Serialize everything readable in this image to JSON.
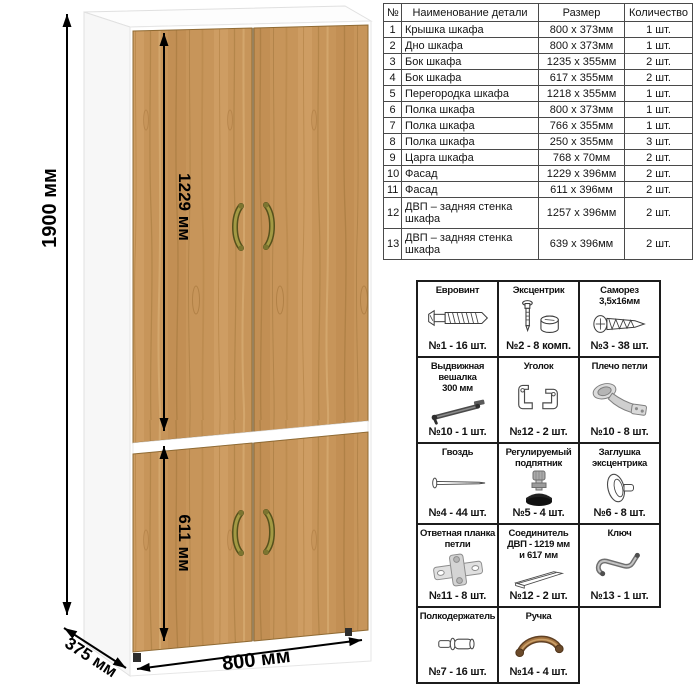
{
  "diagram": {
    "dim_height": "1900 мм",
    "dim_top_section": "1229 мм",
    "dim_bottom_section": "611 мм",
    "dim_width": "800 мм",
    "dim_depth": "375 мм",
    "wood_color": "#c7955a",
    "carcass_color": "#ffffff",
    "handle_color": "#8f8a2f"
  },
  "parts_table": {
    "headers": {
      "num": "№",
      "name": "Наименование детали",
      "size": "Размер",
      "qty": "Количество"
    },
    "rows": [
      {
        "num": "1",
        "name": "Крышка шкафа",
        "size": "800 х 373мм",
        "qty": "1 шт."
      },
      {
        "num": "2",
        "name": "Дно шкафа",
        "size": "800 х 373мм",
        "qty": "1 шт."
      },
      {
        "num": "3",
        "name": "Бок шкафа",
        "size": "1235 х 355мм",
        "qty": "2 шт."
      },
      {
        "num": "4",
        "name": "Бок шкафа",
        "size": "617 х 355мм",
        "qty": "2 шт."
      },
      {
        "num": "5",
        "name": "Перегородка шкафа",
        "size": "1218 х 355мм",
        "qty": "1 шт."
      },
      {
        "num": "6",
        "name": "Полка шкафа",
        "size": "800 х 373мм",
        "qty": "1 шт."
      },
      {
        "num": "7",
        "name": "Полка шкафа",
        "size": "766 х 355мм",
        "qty": "1 шт."
      },
      {
        "num": "8",
        "name": "Полка шкафа",
        "size": "250 х 355мм",
        "qty": "3 шт."
      },
      {
        "num": "9",
        "name": "Царга шкафа",
        "size": "768 х 70мм",
        "qty": "2 шт."
      },
      {
        "num": "10",
        "name": "Фасад",
        "size": "1229 х 396мм",
        "qty": "2 шт."
      },
      {
        "num": "11",
        "name": "Фасад",
        "size": "611 х 396мм",
        "qty": "2 шт."
      },
      {
        "num": "12",
        "name": "ДВП – задняя стенка шкафа",
        "size": "1257 х 396мм",
        "qty": "2 шт."
      },
      {
        "num": "13",
        "name": "ДВП – задняя стенка шкафа",
        "size": "639 х 396мм",
        "qty": "2 шт."
      }
    ]
  },
  "hardware": {
    "items": [
      {
        "title": "Евровинт",
        "count": "№1 - 16 шт.",
        "icon": "euro-screw-icon"
      },
      {
        "title": "Эксцентрик",
        "count": "№2 - 8 комп.",
        "icon": "cam-lock-icon"
      },
      {
        "title": "Саморез\n3,5х16мм",
        "count": "№3 - 38 шт.",
        "icon": "self-tapping-screw-icon"
      },
      {
        "title": "Выдвижная\nвешалка\n300 мм",
        "count": "№10 - 1 шт.",
        "icon": "pullout-hanger-icon"
      },
      {
        "title": "Уголок",
        "count": "№12 - 2 шт.",
        "icon": "corner-bracket-icon"
      },
      {
        "title": "Плечо петли",
        "count": "№10 - 8 шт.",
        "icon": "hinge-arm-icon"
      },
      {
        "title": "Гвоздь",
        "count": "№4 - 44 шт.",
        "icon": "nail-icon"
      },
      {
        "title": "Регулируемый\nподпятник",
        "count": "№5 - 4 шт.",
        "icon": "adjustable-foot-icon"
      },
      {
        "title": "Заглушка\nэксцентрика",
        "count": "№6 - 8 шт.",
        "icon": "cam-cover-icon"
      },
      {
        "title": "Ответная планка\nпетли",
        "count": "№11 - 8 шт.",
        "icon": "hinge-plate-icon"
      },
      {
        "title": "Соединитель\nДВП - 1219 мм\nи 617 мм",
        "count": "№12 - 2 шт.",
        "icon": "hdf-connector-icon"
      },
      {
        "title": "Ключ",
        "count": "№13 - 1 шт.",
        "icon": "hex-key-icon"
      },
      {
        "title": "Полкодержатель",
        "count": "№7 - 16 шт.",
        "icon": "shelf-pin-icon"
      },
      {
        "title": "Ручка",
        "count": "№14 - 4 шт.",
        "icon": "handle-icon"
      }
    ]
  }
}
